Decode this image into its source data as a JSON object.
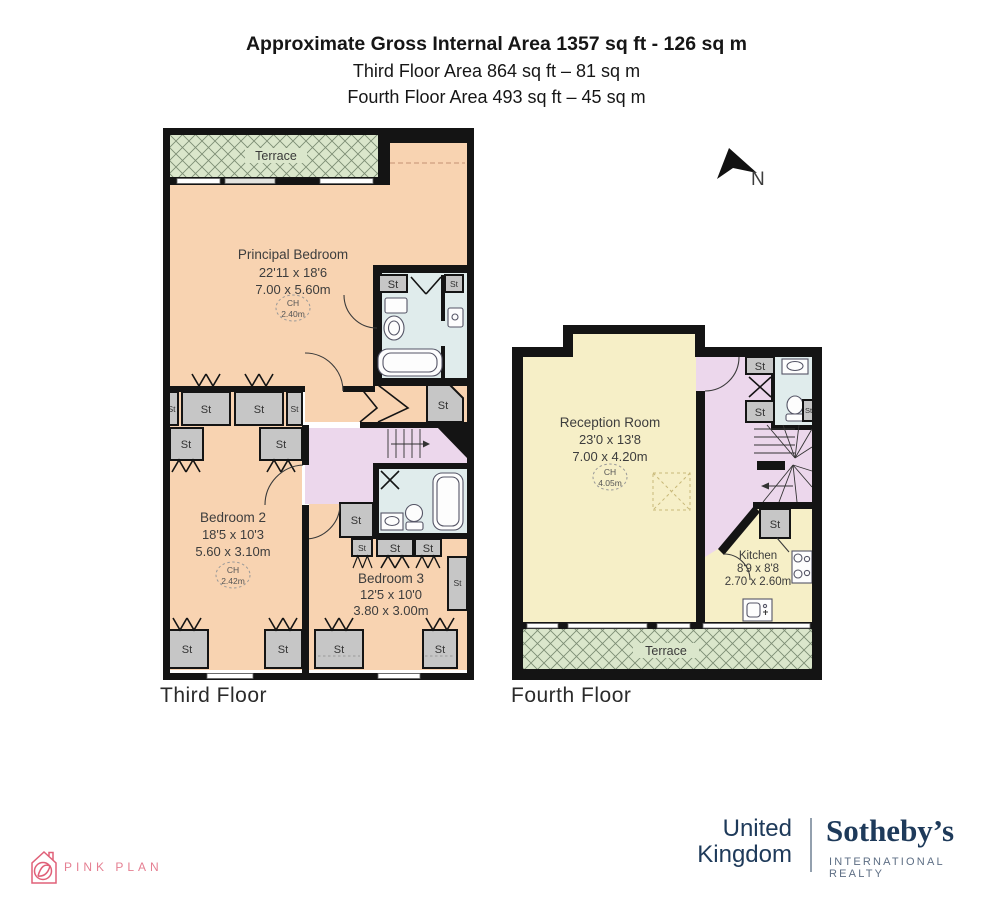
{
  "header": {
    "title": "Approximate Gross Internal Area 1357 sq ft - 126 sq m",
    "subtitle1": "Third Floor Area 864 sq ft – 81 sq m",
    "subtitle2": "Fourth Floor Area 493 sq ft – 45 sq m"
  },
  "compass": {
    "north": "N"
  },
  "labels": {
    "st": "St",
    "ch": "CH",
    "terrace": "Terrace"
  },
  "third": {
    "floor_label": "Third Floor",
    "principal": {
      "name": "Principal Bedroom",
      "imperial": "22'11 x 18'6",
      "metric": "7.00 x 5.60m",
      "ceiling": "2.40m"
    },
    "bedroom2": {
      "name": "Bedroom 2",
      "imperial": "18'5 x 10'3",
      "metric": "5.60 x 3.10m",
      "ceiling": "2.42m"
    },
    "bedroom3": {
      "name": "Bedroom 3",
      "imperial": "12'5 x 10'0",
      "metric": "3.80 x 3.00m"
    }
  },
  "fourth": {
    "floor_label": "Fourth Floor",
    "reception": {
      "name": "Reception Room",
      "imperial": "23'0 x 13'8",
      "metric": "7.00 x 4.20m",
      "ceiling": "4.05m"
    },
    "kitchen": {
      "name": "Kitchen",
      "imperial": "8'9 x 8'8",
      "metric": "2.70 x 2.60m"
    }
  },
  "branding": {
    "pink_plan": "PINK PLAN",
    "region_line1": "United",
    "region_line2": "Kingdom",
    "brand_name": "Sotheby’s",
    "brand_tagline": "INTERNATIONAL REALTY"
  },
  "colors": {
    "room_peach": "#f8d3b1",
    "room_yellow": "#f6efc7",
    "hall_purple": "#ecd7ec",
    "bath_blue": "#e0ecec",
    "closet_grey": "#c6c6c6",
    "terrace_green": "#dae6cb",
    "wall_black": "#141414",
    "brand_navy": "#1e3a5a",
    "brand_pink": "#e57f92"
  }
}
